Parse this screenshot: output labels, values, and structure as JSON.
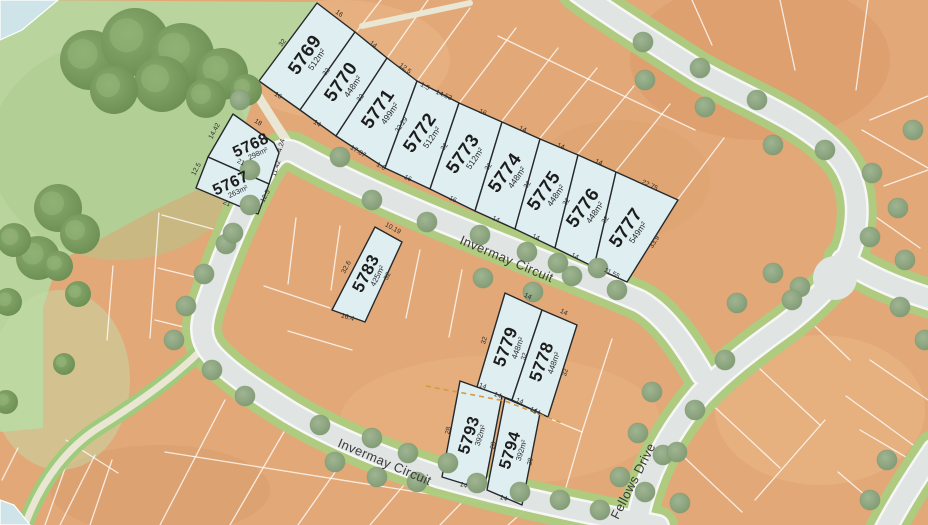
{
  "map_title": "Estate masterplan lot map",
  "streets": [
    {
      "name": "Invermay Circuit"
    },
    {
      "name": "Invermay Circuit"
    },
    {
      "name": "Fellows Drive"
    }
  ],
  "lots": [
    {
      "number": "5769",
      "area": "512m²",
      "dims": [
        "16",
        "32",
        "16",
        "32"
      ]
    },
    {
      "number": "5770",
      "area": "448m²",
      "dims": [
        "14",
        "32",
        "14"
      ]
    },
    {
      "number": "5771",
      "area": "499m²",
      "dims": [
        "12.5",
        "32.29",
        "17.07",
        "1.6"
      ]
    },
    {
      "number": "5772",
      "area": "512m²",
      "dims": [
        "1.5",
        "14.53",
        "32",
        "16"
      ]
    },
    {
      "number": "5773",
      "area": "512m²",
      "dims": [
        "16",
        "32",
        "16"
      ]
    },
    {
      "number": "5774",
      "area": "448m²",
      "dims": [
        "14",
        "32",
        "14"
      ]
    },
    {
      "number": "5775",
      "area": "448m²",
      "dims": [
        "14",
        "32",
        "14"
      ]
    },
    {
      "number": "5776",
      "area": "448m²",
      "dims": [
        "14",
        "32",
        "14"
      ]
    },
    {
      "number": "5777",
      "area": "549m²",
      "dims": [
        "22.75",
        "33.9",
        "11.55"
      ]
    },
    {
      "number": "5768",
      "area": "298m²",
      "dims": [
        "18",
        "14.42",
        "4.24",
        "11.42",
        "21"
      ]
    },
    {
      "number": "5767",
      "area": "263m²",
      "dims": [
        "12.5",
        "12.5",
        "21"
      ]
    },
    {
      "number": "5783",
      "area": "425m²",
      "dims": [
        "10.19",
        "32.6",
        "32",
        "16.4"
      ]
    },
    {
      "number": "5779",
      "area": "448m²",
      "dims": [
        "14",
        "32",
        "32",
        "14"
      ]
    },
    {
      "number": "5778",
      "area": "448m²",
      "dims": [
        "14",
        "32",
        "14"
      ]
    },
    {
      "number": "5793",
      "area": "392m²",
      "dims": [
        "14",
        "28",
        "28",
        "14"
      ]
    },
    {
      "number": "5794",
      "area": "392m²",
      "dims": [
        "14",
        "14",
        "28",
        "14"
      ]
    }
  ],
  "colors": {
    "available_lot": "#deeef1",
    "lot_outline": "#26292b",
    "sold_land": "#e2a878",
    "park": "#b9d49d",
    "road": "#e0e5e3",
    "verge": "#abcc81",
    "path": "#eae6d4",
    "stage_dash": "#d69a3e",
    "water_corner": "#cfe4e8"
  }
}
